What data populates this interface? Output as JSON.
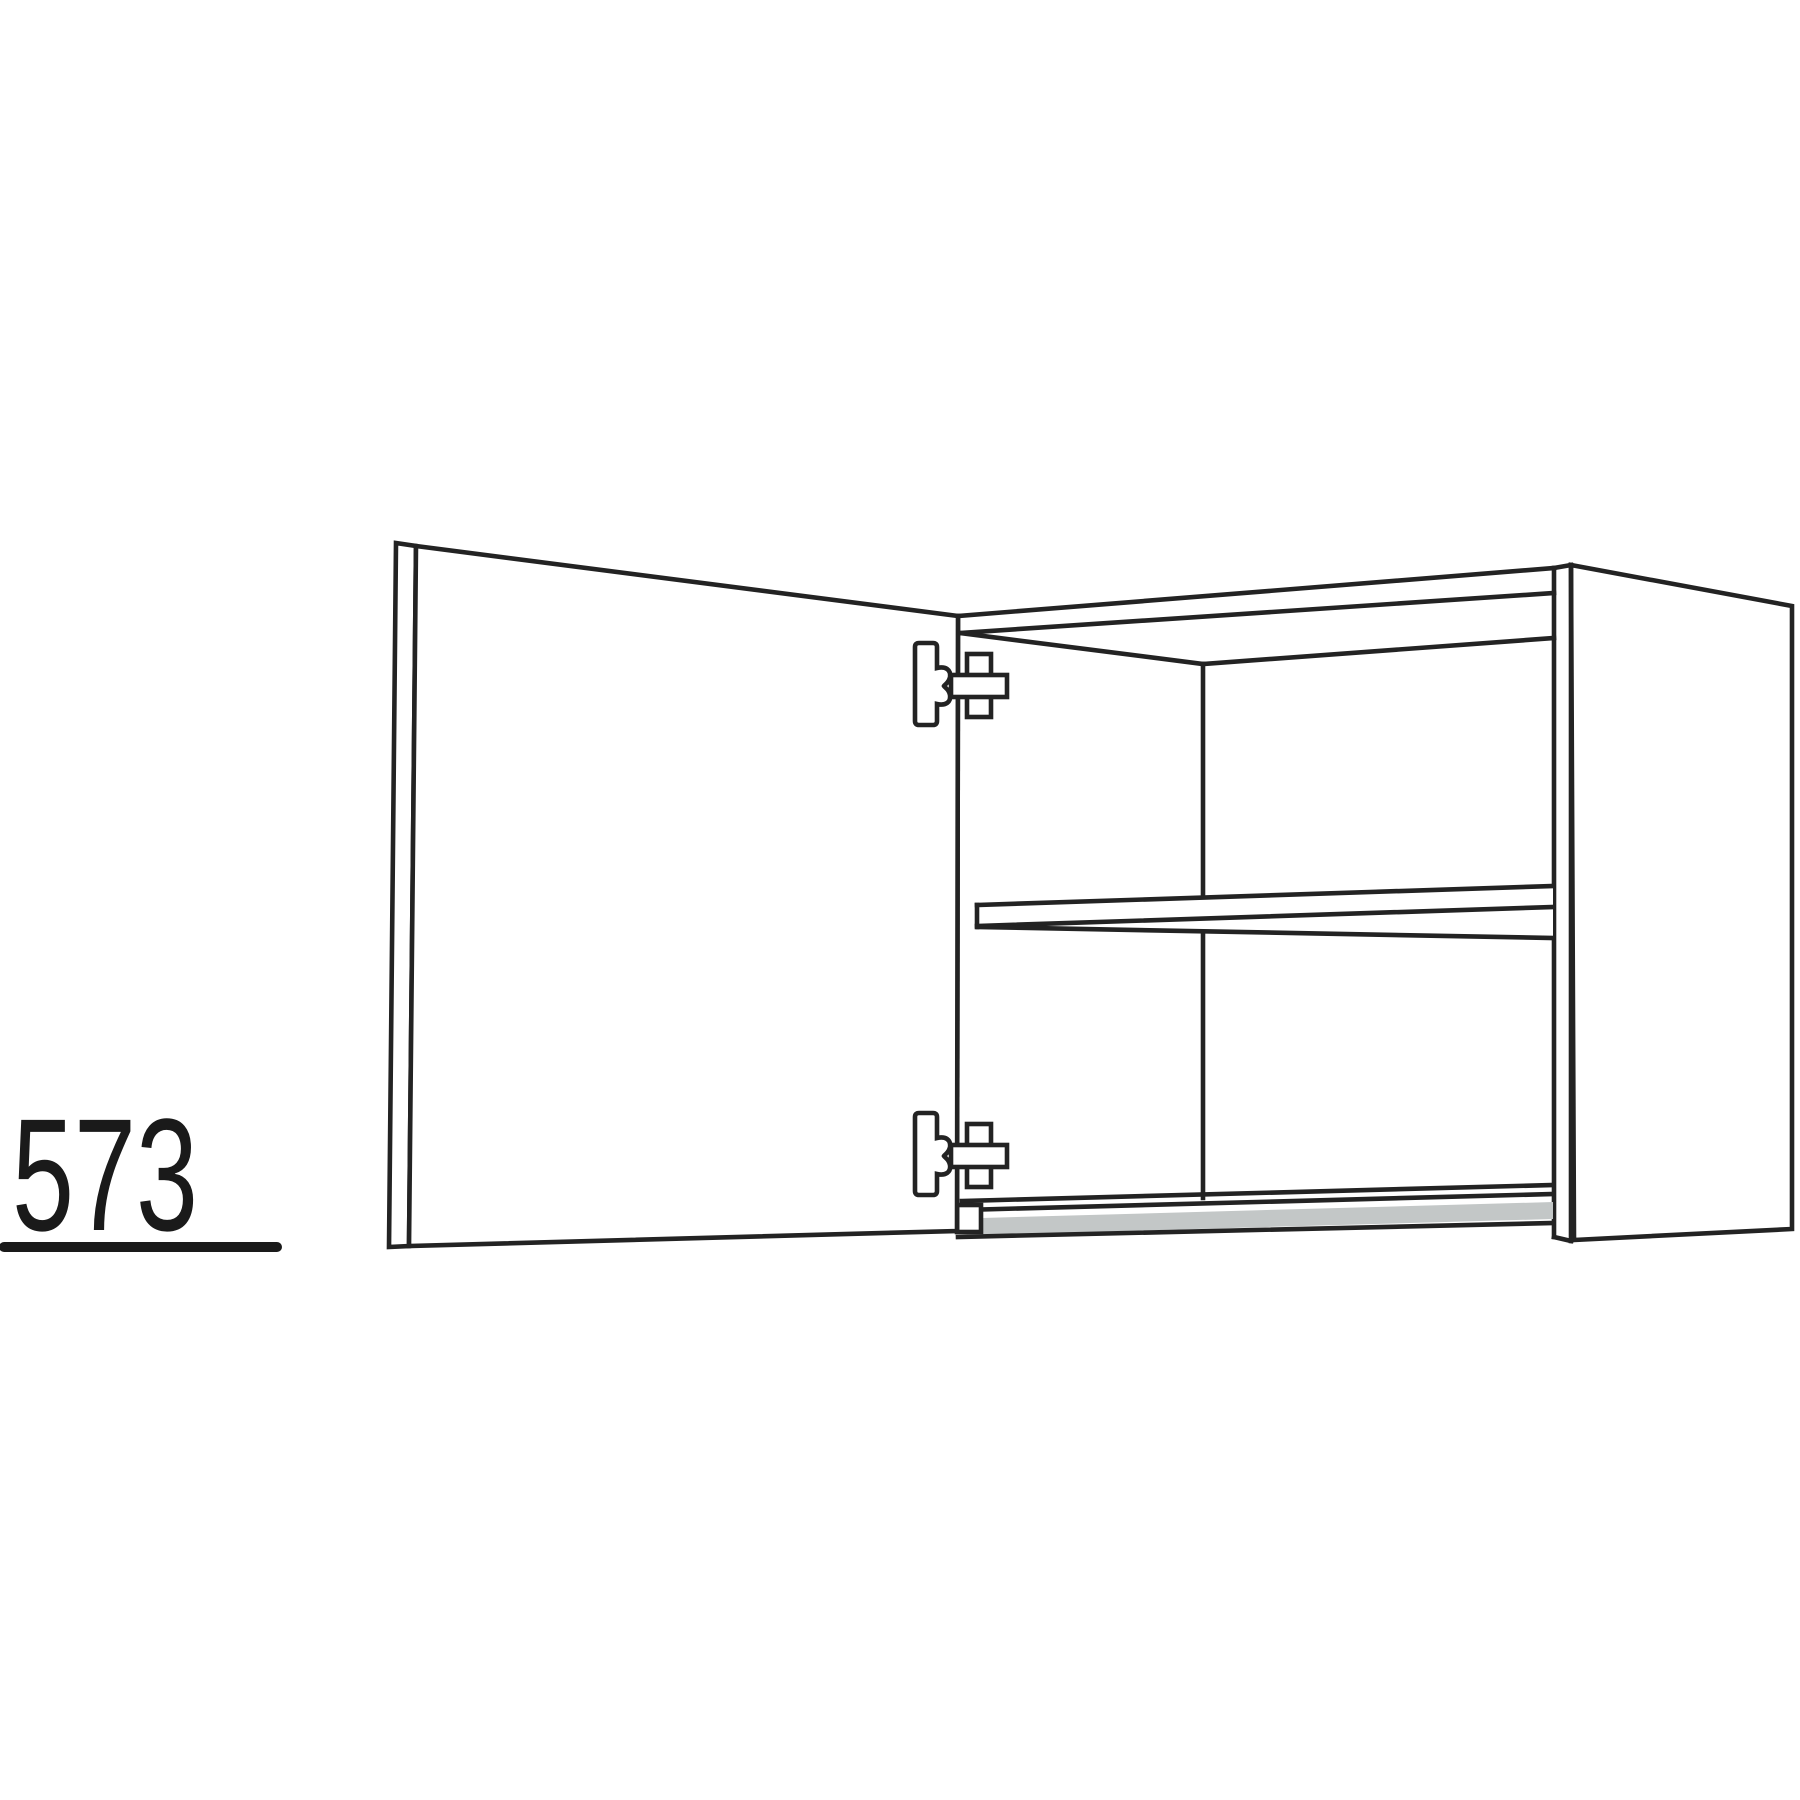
{
  "diagram": {
    "dimension_label": "573"
  },
  "colors": {
    "line_color": "#232323",
    "panel_fill": "#ffffff",
    "bottom_edge_gray": "#c3c7c7",
    "background": "#ffffff",
    "label_color": "#1a1a1a"
  }
}
